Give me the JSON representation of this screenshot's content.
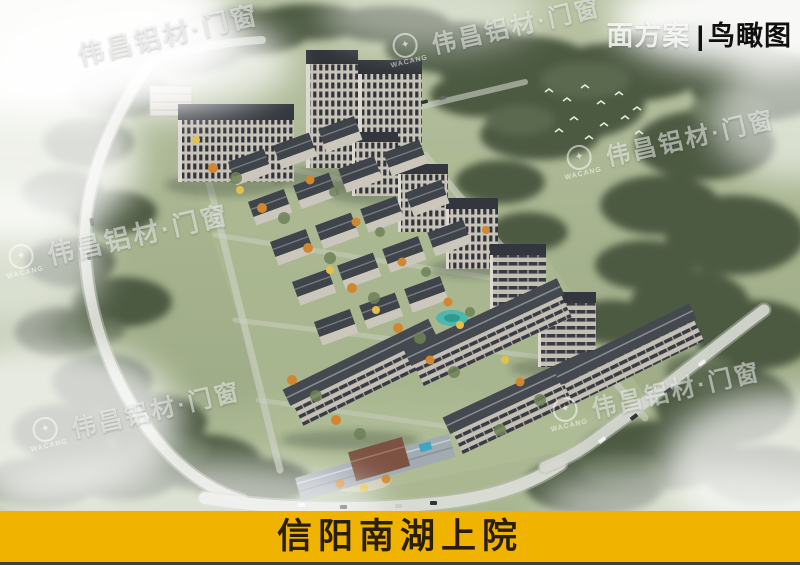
{
  "image": {
    "type_label": {
      "prefix": "面方案",
      "separator": "|",
      "title": "鸟瞰图"
    }
  },
  "watermark": {
    "text": "伟昌铝材·门窗",
    "brand": "WACANG"
  },
  "banner": {
    "title": "信阳南湖上院"
  },
  "colors": {
    "banner_bg": "#F0B300",
    "banner_text": "#2A1E05",
    "label_title_color": "#101010",
    "label_prefix_color": "rgba(255,255,255,0.82)",
    "watermark_color": "rgba(255,255,255,0.52)"
  }
}
